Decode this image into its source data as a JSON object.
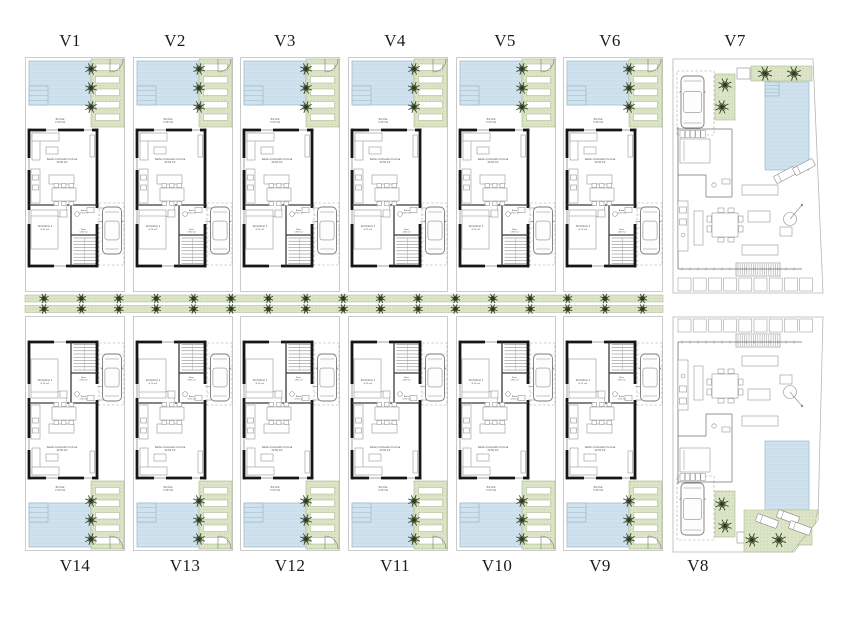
{
  "page": {
    "type": "architectural-site-plan",
    "description": "Site floor plan of 14 villas with pools, gardens and parking"
  },
  "labels": {
    "top": [
      "V1",
      "V2",
      "V3",
      "V4",
      "V5",
      "V6",
      "V7"
    ],
    "bottom": [
      "V14",
      "V13",
      "V12",
      "V11",
      "V10",
      "V9",
      "V8"
    ]
  },
  "rooms": {
    "living": {
      "name": "Salón-Comedor-Cocina",
      "area": "22.50 m2"
    },
    "bedroom": {
      "name": "Dormitorio 1",
      "area": "8.75 m2"
    },
    "bath": {
      "name": "Baño",
      "area": "3.90 m2"
    },
    "hall": {
      "name": "Paso",
      "area": "1.85 m2"
    },
    "porch": {
      "name": "Porche",
      "area": "7.20 m2"
    }
  },
  "colors": {
    "pool": "#cfe2ee",
    "pool_line": "#9db8c8",
    "pool_stripe": "#bcd3e1",
    "green": "#dbe4c6",
    "green_dot": "#c3d0a4",
    "green_line": "#a9b88c",
    "tree": "#2c3a1e",
    "wall": "#161616",
    "partition": "#3a3a3a",
    "furniture": "#8c8c8c",
    "border": "#b5b5b5",
    "label": "#1c1c1c",
    "tiny_text": "#444444"
  }
}
